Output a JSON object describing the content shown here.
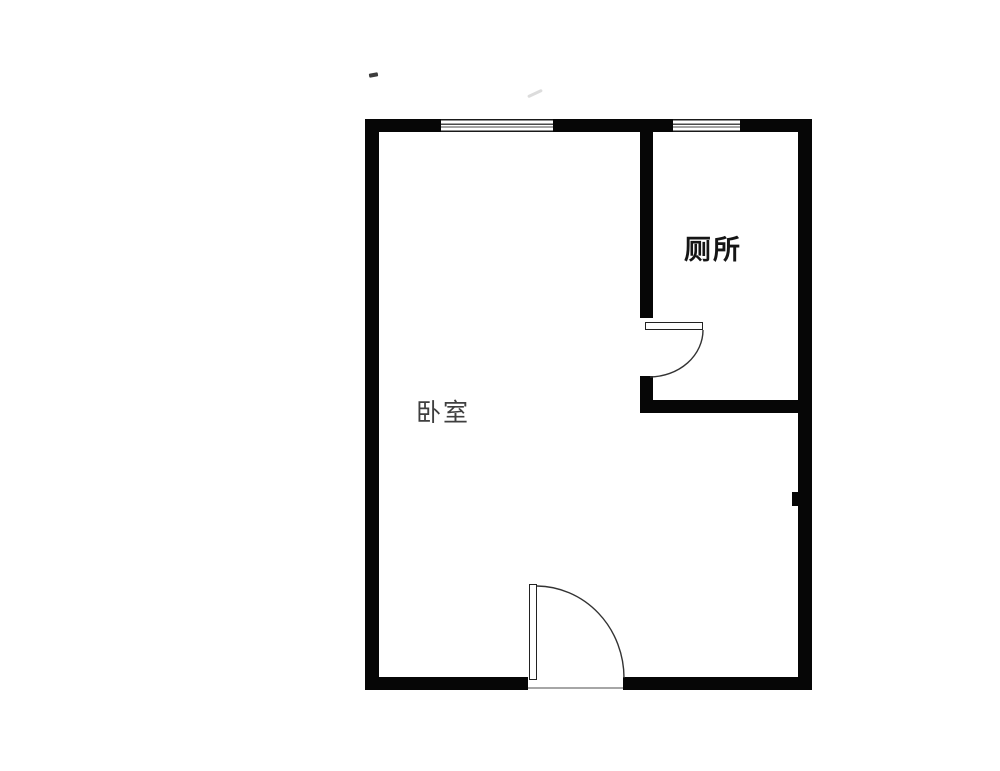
{
  "floorplan": {
    "labels": {
      "bedroom": "卧室",
      "toilet": "厕所"
    },
    "colors": {
      "background": "#ffffff",
      "wall": "#060606",
      "window_line": "#1a1a1a",
      "door_stroke": "#333333",
      "threshold": "#a6a6a6",
      "toilet_label": "#151515",
      "bedroom_label": "#3f3f3f"
    },
    "features": {
      "windows": [
        "top-wall-window-left",
        "top-wall-window-right"
      ],
      "doors": [
        "bedroom-entry-door",
        "toilet-door"
      ],
      "rooms": [
        "bedroom",
        "toilet"
      ]
    }
  }
}
